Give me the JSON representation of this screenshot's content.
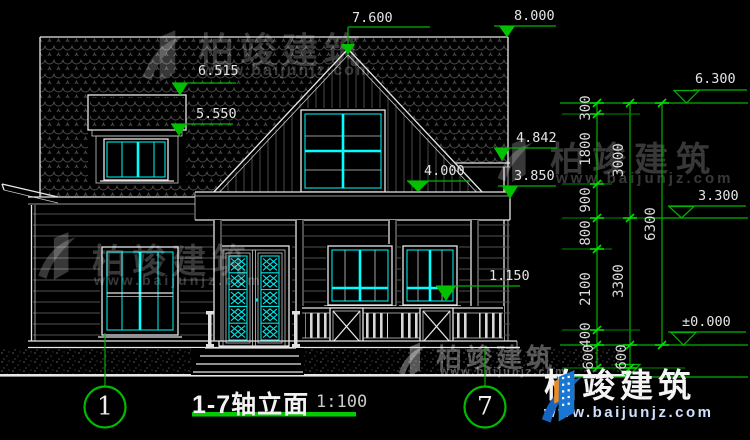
{
  "document": {
    "title": "1-7轴立面",
    "scale": "1:100"
  },
  "axis_bubbles": {
    "left": "1",
    "right": "7"
  },
  "elevation_markers": {
    "main_ridge": "8.000",
    "gable_peak": "7.600",
    "dormer_roof_top": "6.515",
    "dormer_eave": "5.550",
    "right_eave_top": "4.842",
    "porch_roof": "4.000",
    "right_eave_bottom": "3.850",
    "porch_railing": "1.150",
    "eave_level": "6.300",
    "mid_level": "3.300",
    "ground_level": "±0.000"
  },
  "dimension_chains": {
    "inner": [
      "300",
      "1800",
      "900",
      "800",
      "2100",
      "400",
      "600"
    ],
    "middle": [
      "3000",
      "3300",
      "600"
    ],
    "overall": [
      "6300"
    ]
  },
  "watermark": {
    "brand": "柏竣建筑",
    "site": "www.baijunjz.com"
  },
  "colors": {
    "background": "#000000",
    "line_white": "#e8e8e8",
    "accent_cyan": "#00e6e6",
    "dim_green": "#00b400",
    "siding_gray": "#555555"
  }
}
